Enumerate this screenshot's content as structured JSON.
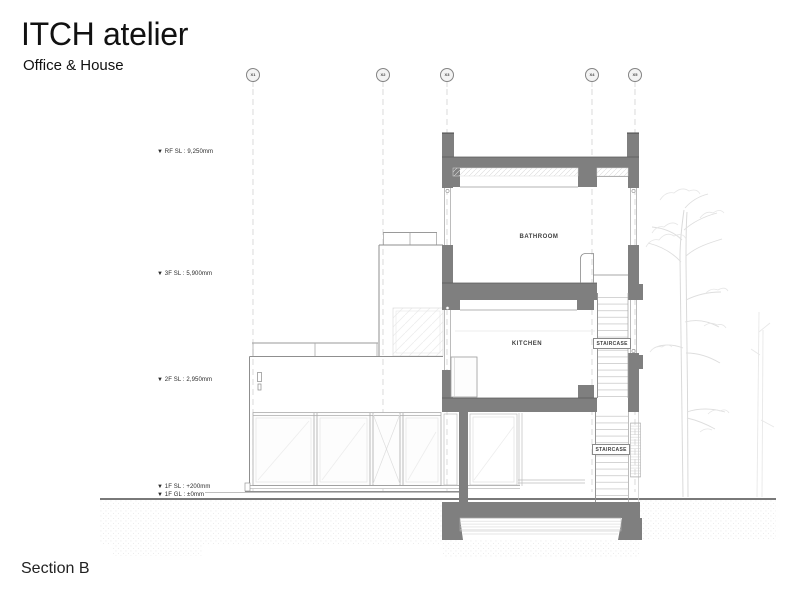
{
  "header": {
    "title": "ITCH atelier",
    "subtitle": "Office & House"
  },
  "footer": {
    "section_label": "Section B"
  },
  "grid_markers": [
    {
      "label": "X1"
    },
    {
      "label": "X2"
    },
    {
      "label": "X3"
    },
    {
      "label": "X4"
    },
    {
      "label": "X5"
    }
  ],
  "level_markers": [
    {
      "label": "▼ RF SL : 9,250mm"
    },
    {
      "label": "▼ 3F SL : 5,900mm"
    },
    {
      "label": "▼ 2F SL : 2,950mm"
    },
    {
      "label": "▼ 1F SL : +200mm"
    },
    {
      "label": "▼ 1F GL : ±0mm"
    }
  ],
  "room_labels": [
    {
      "name": "BATHROOM"
    },
    {
      "name": "KITCHEN"
    },
    {
      "name": "STAIRCASE"
    },
    {
      "name": "STAIRCASE"
    }
  ],
  "colors": {
    "poche_gray": "#7f7f7f",
    "outline": "#4a4a4a",
    "light_line": "#bdbdbd",
    "tree_sketch": "#d9d9d9",
    "text": "#1a1a1a"
  }
}
